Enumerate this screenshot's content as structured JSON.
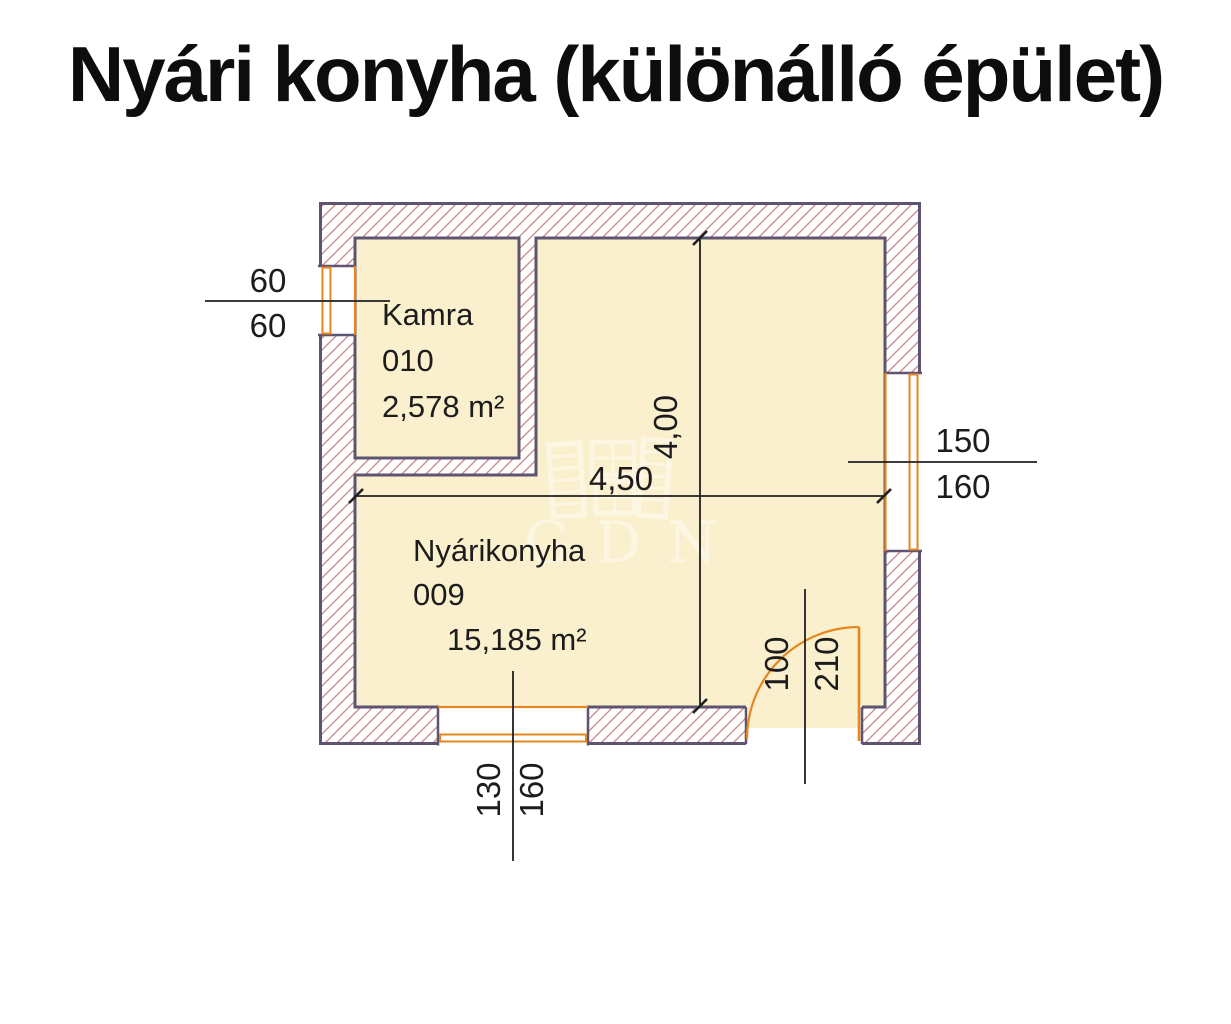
{
  "title": "Nyári konyha (különálló épület)",
  "watermark": {
    "text": "GDN"
  },
  "rooms": [
    {
      "name": "Kamra",
      "number": "010",
      "area": "2,578 m²"
    },
    {
      "name": "Nyárikonyha",
      "number": "009",
      "area": "15,185 m²"
    }
  ],
  "dimensions": {
    "room_width": "4,50",
    "room_height": "4,00",
    "left_window": {
      "top": "60",
      "bottom": "60"
    },
    "right_window": {
      "top": "150",
      "bottom": "160"
    },
    "bottom_window": {
      "left": "130",
      "right": "160"
    },
    "door": {
      "left": "100",
      "right": "210"
    }
  },
  "colors": {
    "wall_outline": "#5e5370",
    "wall_hatch": "#c98f92",
    "room_fill": "#faf0cd",
    "frame_orange": "#e6861e",
    "dimension_ink": "#1c1c1c",
    "background": "#ffffff"
  }
}
